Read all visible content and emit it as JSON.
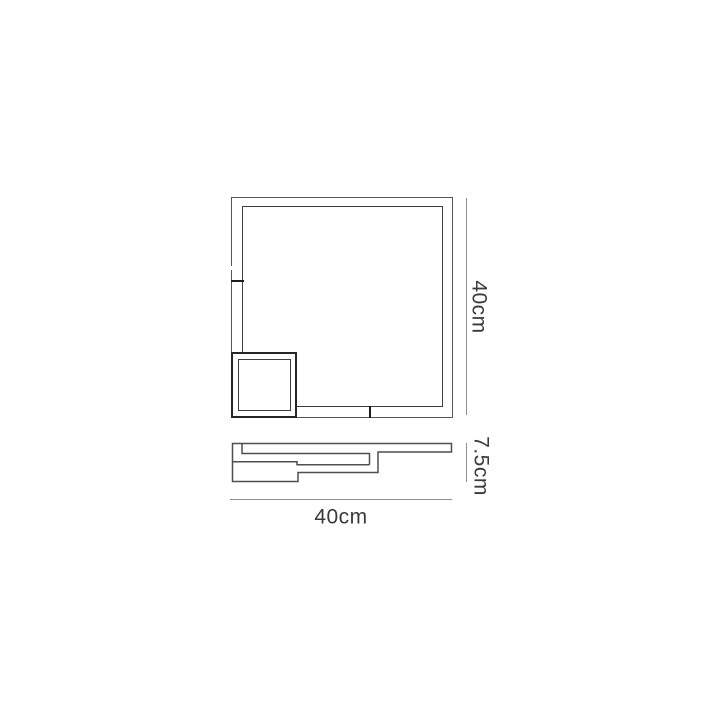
{
  "diagram": {
    "type": "product-dimension-drawing",
    "labels": {
      "height": "40cm",
      "depth": "7.5cm",
      "width": "40cm"
    },
    "colors": {
      "background": "#ffffff",
      "fixture_outer_line": "#565656",
      "fixture_inner_line": "#3c3c3c",
      "small_square_line": "#262626",
      "seam_line": "#1c1c1c",
      "dimension_line": "#8f8f8f",
      "label_text": "#3a3a3a"
    }
  }
}
